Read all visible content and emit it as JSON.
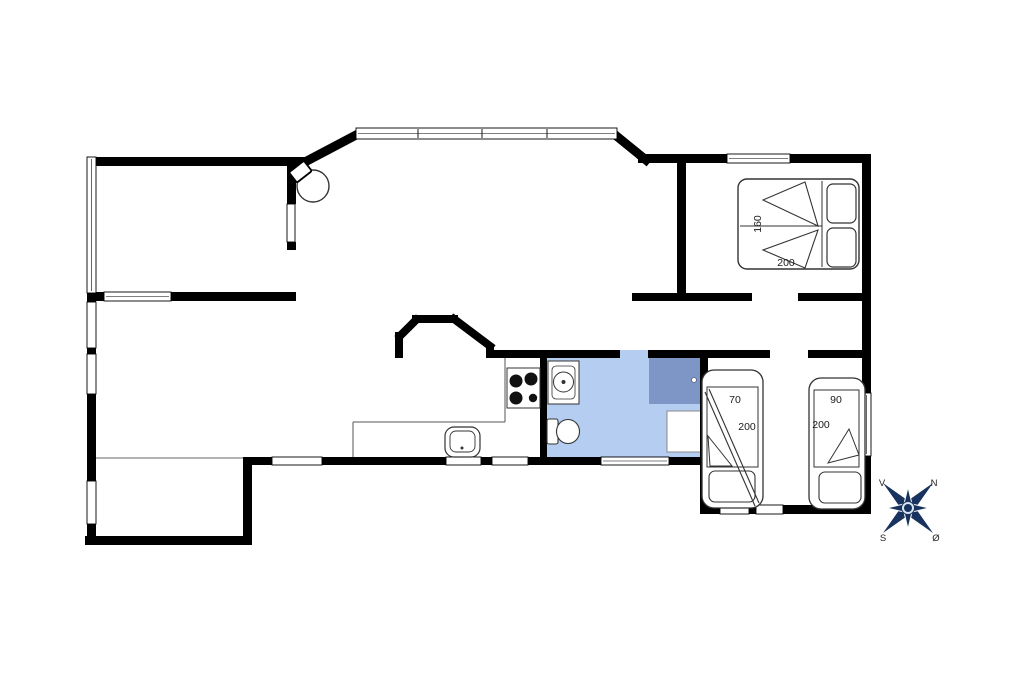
{
  "floorplan": {
    "colors": {
      "wall": "#000000",
      "bathroom_floor": "#b5cdf0",
      "shower": "#7e96c5",
      "compass": "#17335e",
      "compass_ring": "#d9e4f4",
      "dimension_text": "#1a1a1a"
    },
    "dimensions": {
      "double_bed_width": "160",
      "double_bed_length": "200",
      "single_bed_1_width": "70",
      "single_bed_1_length": "200",
      "single_bed_2_width": "90",
      "single_bed_2_length": "200"
    },
    "compass": {
      "west": "V",
      "north": "N",
      "south": "S",
      "east": "Ø"
    },
    "icons": [
      "double-bed-icon",
      "single-bed-icon",
      "wood-stove-icon",
      "cooktop-icon",
      "kitchen-sink-icon",
      "washbasin-icon",
      "toilet-icon",
      "shower-icon",
      "compass-rose-icon"
    ]
  }
}
